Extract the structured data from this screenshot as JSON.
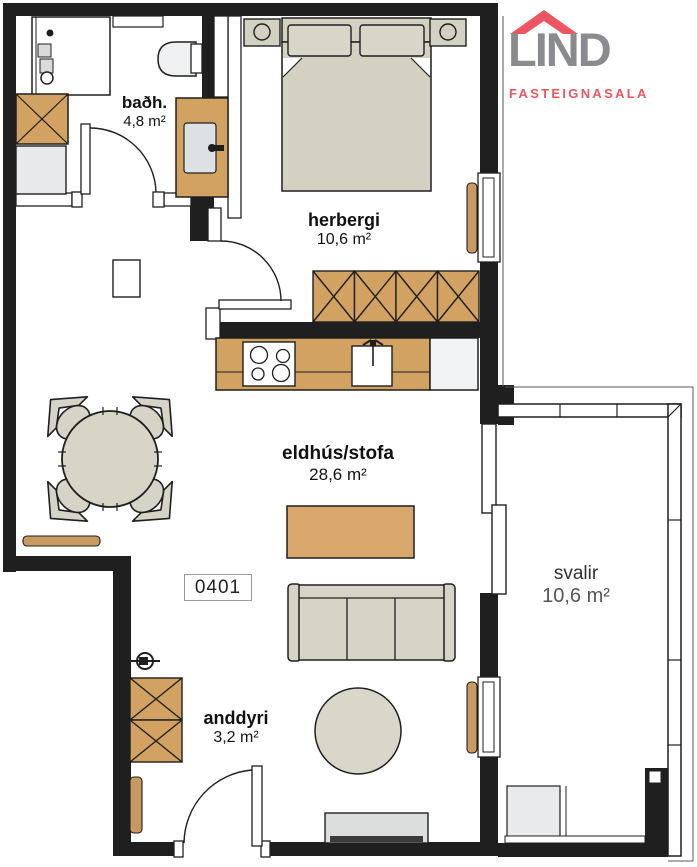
{
  "brand": {
    "name": "LIND",
    "tagline": "FASTEIGNASALA"
  },
  "unit": {
    "number": "0401"
  },
  "rooms": [
    {
      "key": "bathroom",
      "label": "baðh.",
      "area": "4,8 m²"
    },
    {
      "key": "bedroom",
      "label": "herbergi",
      "area": "10,6 m²"
    },
    {
      "key": "kitchen-living",
      "label": "eldhús/stofa",
      "area": "28,6 m²"
    },
    {
      "key": "balcony",
      "label": "svalir",
      "area": "10,6 m²"
    },
    {
      "key": "entry",
      "label": "anddyri",
      "area": "3,2 m²"
    }
  ],
  "colors": {
    "wall": "#1f1f1f",
    "wood": "#d2a263",
    "coffee_table": "#d9a76b",
    "furniture_beige": "#d6d4c6",
    "appliance_gray": "#e7e9ea",
    "rug": "#d9d7ca",
    "logo_gray": "#8a8b8e",
    "logo_red": "#ee5560"
  }
}
